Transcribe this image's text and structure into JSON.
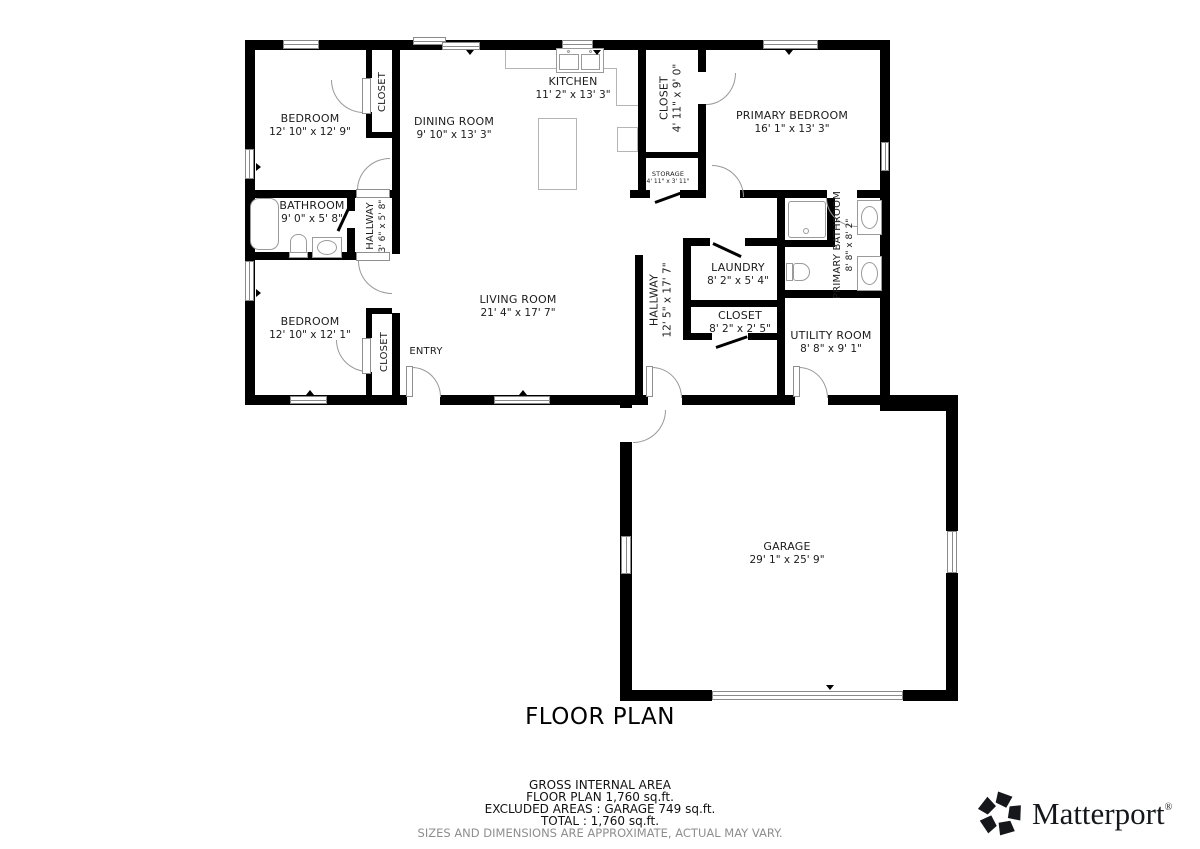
{
  "title": "FLOOR PLAN",
  "rooms": [
    {
      "name": "BEDROOM",
      "dims": "12' 10\" x 12' 9\""
    },
    {
      "name": "CLOSET",
      "dims": ""
    },
    {
      "name": "DINING ROOM",
      "dims": "9' 10\" x 13' 3\""
    },
    {
      "name": "KITCHEN",
      "dims": "11' 2\" x 13' 3\""
    },
    {
      "name": "CLOSET",
      "dims": "4' 11\" x 9' 0\""
    },
    {
      "name": "PRIMARY BEDROOM",
      "dims": "16' 1\" x 13' 3\""
    },
    {
      "name": "BATHROOM",
      "dims": "9' 0\" x 5' 8\""
    },
    {
      "name": "HALLWAY",
      "dims": "3' 6\" x 5' 8\""
    },
    {
      "name": "STORAGE",
      "dims": "4' 11\" x 3' 11\""
    },
    {
      "name": "PRIMARY BATHROOM",
      "dims": "8' 8\" x 8' 2\""
    },
    {
      "name": "BEDROOM",
      "dims": "12' 10\" x 12' 1\""
    },
    {
      "name": "CLOSET",
      "dims": ""
    },
    {
      "name": "LIVING ROOM",
      "dims": "21' 4\" x 17' 7\""
    },
    {
      "name": "ENTRY",
      "dims": ""
    },
    {
      "name": "HALLWAY",
      "dims": "12' 5\" x 17' 7\""
    },
    {
      "name": "LAUNDRY",
      "dims": "8' 2\" x 5' 4\""
    },
    {
      "name": "CLOSET",
      "dims": "8' 2\" x 2' 5\""
    },
    {
      "name": "UTILITY ROOM",
      "dims": "8' 8\" x 9' 1\""
    },
    {
      "name": "GARAGE",
      "dims": "29' 1\" x 25' 9\""
    }
  ],
  "summary": {
    "heading": "GROSS INTERNAL AREA",
    "line1": "FLOOR PLAN 1,760 sq.ft.",
    "line2": "EXCLUDED AREAS :  GARAGE 749 sq.ft.",
    "line3": "TOTAL :  1,760 sq.ft.",
    "disclaimer": "SIZES AND DIMENSIONS ARE APPROXIMATE, ACTUAL MAY VARY."
  },
  "brand": {
    "name": "Matterport",
    "registered": "®"
  },
  "colors": {
    "wall": "#000000",
    "text": "#1c1c1c",
    "fixture_line": "#9a9a9a",
    "disclaimer_text": "#8e8e8e"
  }
}
